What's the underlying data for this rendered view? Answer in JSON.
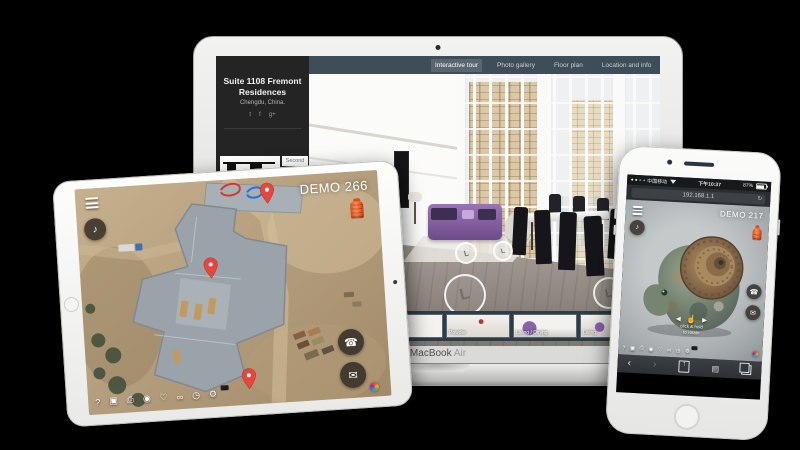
{
  "macbook": {
    "brand": "MacBook",
    "brand_variant": "Air",
    "nav_tabs": [
      {
        "label": "Interactive tour",
        "active": true
      },
      {
        "label": "Photo gallery",
        "active": false
      },
      {
        "label": "Floor plan",
        "active": false
      },
      {
        "label": "Location and info",
        "active": false
      }
    ],
    "sidebar": {
      "title": "Suite 1108 Fremont Residences",
      "location": "Chengdu, China.",
      "social": [
        {
          "name": "twitter-icon",
          "glyph": "t"
        },
        {
          "name": "facebook-icon",
          "glyph": "f"
        },
        {
          "name": "google-plus-icon",
          "glyph": "g+"
        }
      ],
      "floorplan_tabs": [
        {
          "label": "Second",
          "color": "#777777",
          "active": false
        },
        {
          "label": "Main",
          "color": "#e2574d",
          "active": true
        }
      ]
    },
    "hotspot_glyph": "L",
    "thumbnails": [
      {
        "label": ""
      },
      {
        "label": "Entry"
      },
      {
        "label": "Powder"
      },
      {
        "label": "Living / Dining"
      },
      {
        "label": "Living"
      }
    ],
    "accent_colors": {
      "navbar": "#3e4d58",
      "sidebar": "#242424"
    }
  },
  "tour_toolbar": [
    {
      "name": "help-icon",
      "glyph": "?"
    },
    {
      "name": "vr-icon",
      "glyph": "▣"
    },
    {
      "name": "print-icon",
      "glyph": "⎙"
    },
    {
      "name": "camera-icon",
      "glyph": "◉"
    },
    {
      "name": "favorite-icon",
      "glyph": "♡"
    },
    {
      "name": "link-icon",
      "glyph": "∞"
    },
    {
      "name": "history-icon",
      "glyph": "◷"
    },
    {
      "name": "settings-icon",
      "glyph": "⚙"
    }
  ],
  "ipad": {
    "demo_label": "DEMO 266",
    "music_glyph": "♪",
    "phone_glyph": "☎",
    "email_glyph": "✉",
    "marker_color": "#e8453c",
    "hydrant_color": "#ff6d3a"
  },
  "iphone": {
    "status": {
      "carrier": "中国移动",
      "time": "下午10:37",
      "battery": "87%"
    },
    "address_bar": {
      "url": "192.168.1.1",
      "refresh_glyph": "↻"
    },
    "demo_label": "DEMO 217",
    "music_glyph": "♪",
    "phone_glyph": "☎",
    "email_glyph": "✉",
    "hint": {
      "arrow_left": "◄",
      "hand_glyph": "☝",
      "arrow_right": "►",
      "line1": "click & hold",
      "line2": "to rotate"
    },
    "safari": {
      "back_glyph": "‹",
      "forward_glyph": "›",
      "share_glyph": "↑",
      "bookmarks_glyph": "▤"
    }
  }
}
